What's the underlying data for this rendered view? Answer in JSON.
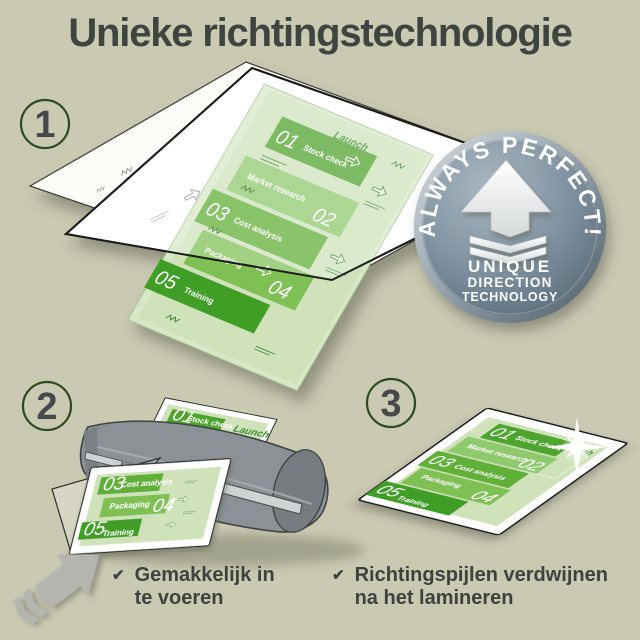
{
  "page": {
    "title": "Unieke richtingstechnologie",
    "background": "#cac9b2"
  },
  "steps": [
    {
      "number": "1"
    },
    {
      "number": "2"
    },
    {
      "number": "3"
    }
  ],
  "badge": {
    "arc_text": "ALWAYS PERFECT!",
    "line1": "UNIQUE",
    "line2": "DIRECTION",
    "line3": "TECHNOLOGY"
  },
  "doc": {
    "items": [
      {
        "num": "01",
        "label": "Stock check"
      },
      {
        "num": "02",
        "label": "Market research"
      },
      {
        "num": "03",
        "label": "Cost analysis"
      },
      {
        "num": "04",
        "label": "Packaging"
      },
      {
        "num": "05",
        "label": "Training"
      }
    ],
    "launch": "Launch"
  },
  "checklist": {
    "item1": {
      "line1": "Gemakkelijk in",
      "line2": "te voeren"
    },
    "item2": {
      "line1": "Richtingspijlen verdwijnen",
      "line2": "na het lamineren"
    }
  },
  "icons": {
    "check": "✔"
  },
  "colors": {
    "background": "#cac9b2",
    "heading_text": "#3e4540",
    "step_ring_green": "#2d4a1c",
    "doc_pale_green": "#cfe2ba",
    "block_green_dark": "#4ea42e",
    "block_green_mid": "#61af37",
    "block_green_light": "#8fc96e",
    "block_green_soft": "#7fc055",
    "block_green_deep": "#3f9d26",
    "launch_green": "#3e9130",
    "badge_gray_blue": "#8294a2",
    "machine_gray": "#8b9195",
    "arrow_gray": "#b4b5af",
    "sheet_white": "#ffffff",
    "outline_black": "#1d1d1a"
  }
}
